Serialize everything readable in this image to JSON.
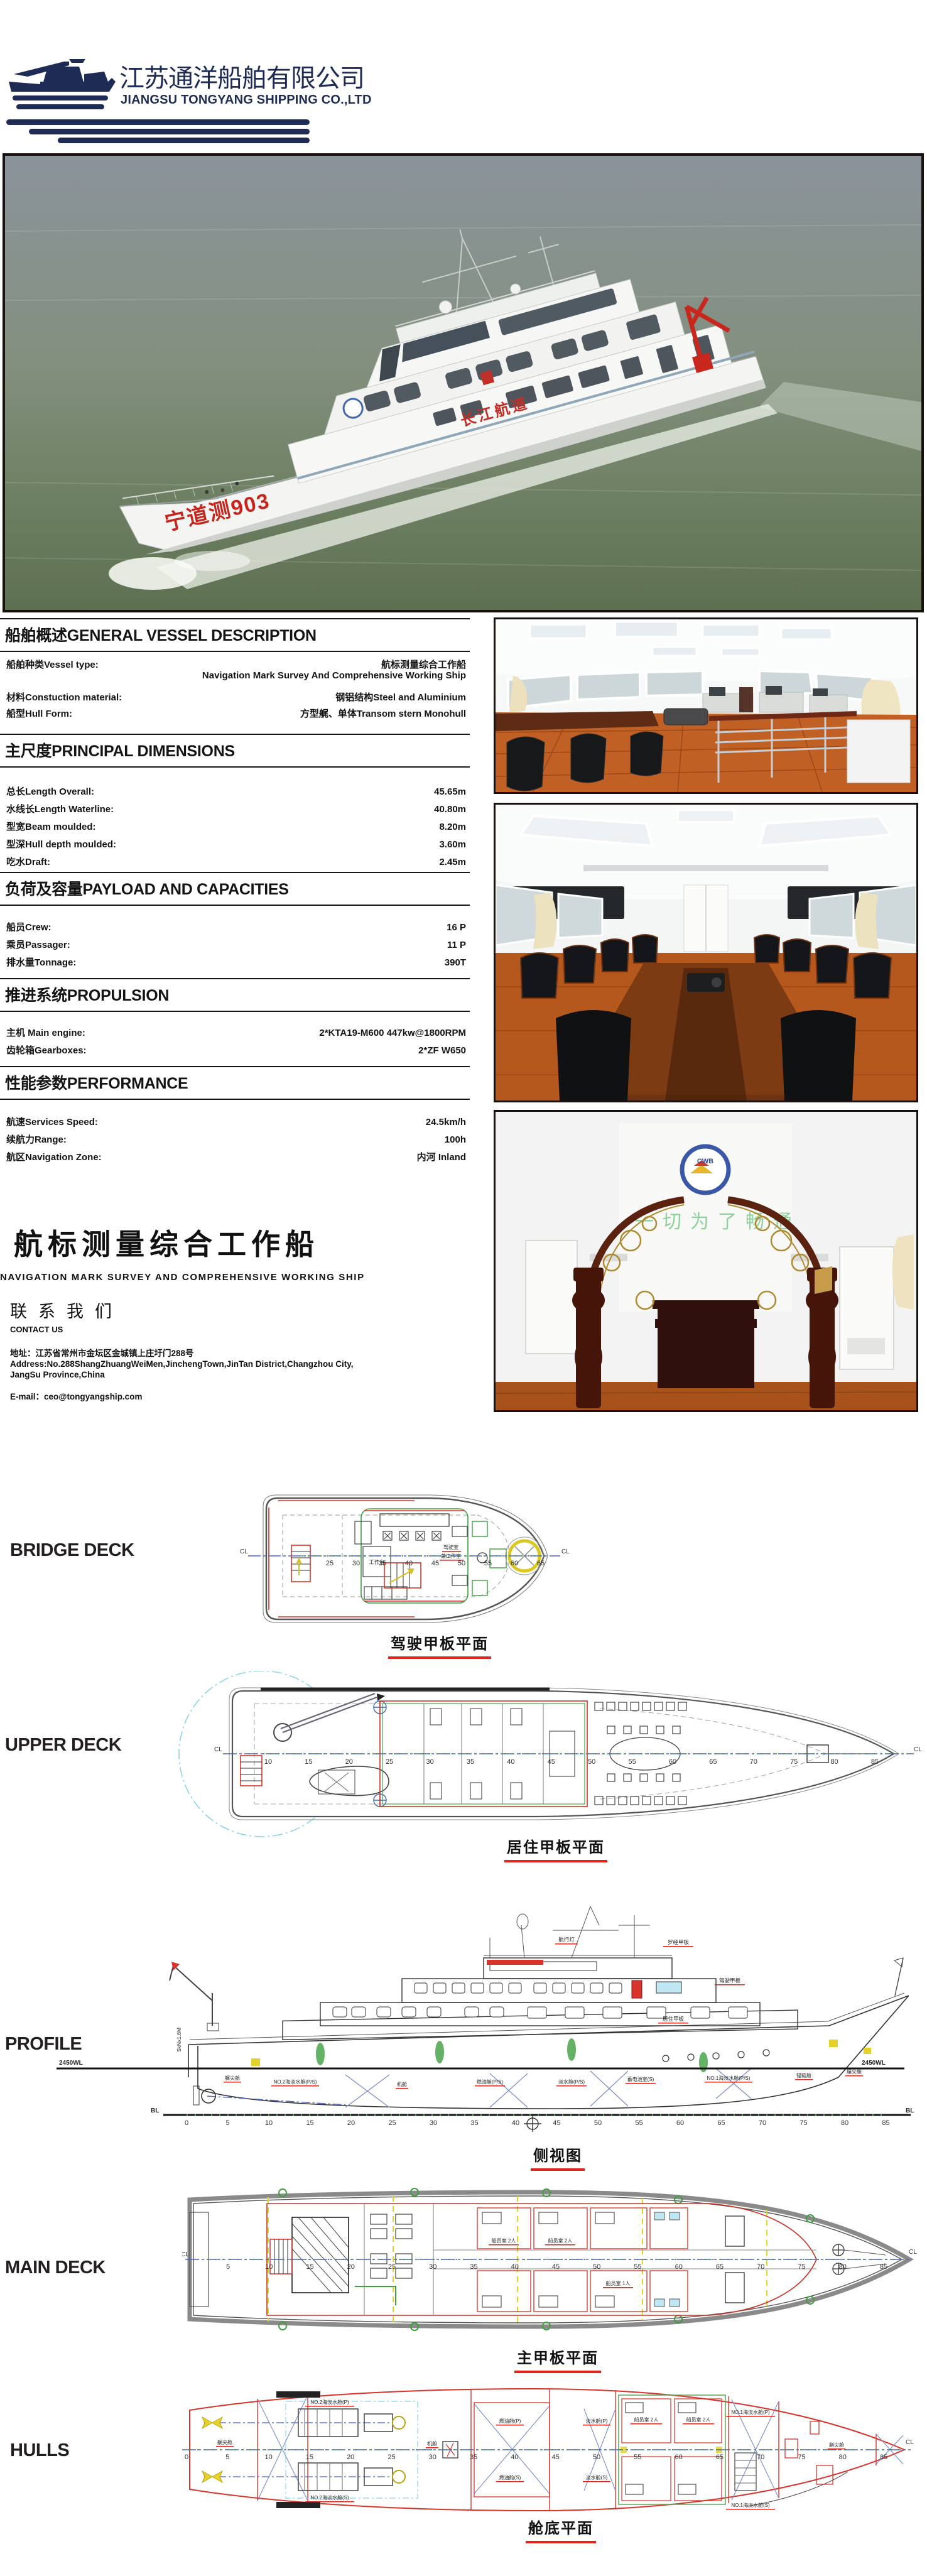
{
  "logo": {
    "company_cn": "江苏通洋船舶有限公司",
    "company_en": "JIANGSU TONGYANG SHIPPING CO.,LTD"
  },
  "main_photo": {
    "hull_name": "宁道测903",
    "side_text": "长江航道"
  },
  "interior": {
    "badge": "CWB",
    "slogan": "一切为了畅通"
  },
  "specs": {
    "general": {
      "title": "船舶概述GENERAL VESSEL DESCRIPTION",
      "rows": [
        {
          "label": "船舶种类Vessel type:",
          "value": "航标测量综合工作船",
          "value2": "Navigation Mark Survey And Comprehensive Working Ship"
        },
        {
          "label": "材料Constuction material:",
          "value": "钢铝结构Steel and Aluminium"
        },
        {
          "label": "船型Hull Form:",
          "value": "方型艉、单体Transom stern  Monohull"
        }
      ]
    },
    "dimensions": {
      "title": "主尺度PRINCIPAL DIMENSIONS",
      "rows": [
        {
          "label": "总长Length Overall:",
          "value": "45.65m"
        },
        {
          "label": "水线长Length Waterline:",
          "value": "40.80m"
        },
        {
          "label": "型宽Beam moulded:",
          "value": "8.20m"
        },
        {
          "label": "型深Hull depth moulded:",
          "value": "3.60m"
        },
        {
          "label": "吃水Draft:",
          "value": "2.45m"
        }
      ]
    },
    "payload": {
      "title": "负荷及容量PAYLOAD AND CAPACITIES",
      "rows": [
        {
          "label": "船员Crew:",
          "value": "16 P"
        },
        {
          "label": "乘员Passager:",
          "value": "11 P"
        },
        {
          "label": "排水量Tonnage:",
          "value": "390T"
        }
      ]
    },
    "propulsion": {
      "title": "推进系统PROPULSION",
      "rows": [
        {
          "label": "主机 Main engine:",
          "value": "2*KTA19-M600 447kw@1800RPM"
        },
        {
          "label": "齿轮箱Gearboxes:",
          "value": "2*ZF W650"
        }
      ]
    },
    "performance": {
      "title": "性能参数PERFORMANCE",
      "rows": [
        {
          "label": "航速Services Speed:",
          "value": "24.5km/h"
        },
        {
          "label": "续航力Range:",
          "value": "100h"
        },
        {
          "label": "航区Navigation Zone:",
          "value": "内河 Inland"
        }
      ]
    }
  },
  "banner": {
    "title_cn": "航标测量综合工作船",
    "title_en": "NAVIGATION MARK SURVEY AND COMPREHENSIVE WORKING SHIP"
  },
  "contact": {
    "heading_cn": "联系我们",
    "heading_en": "CONTACT US",
    "address_cn": "地址：江苏省常州市金坛区金城镇上庄圩门288号",
    "address_en1": "Address:No.288ShangZhuangWeiMen,JinchengTown,JinTan District,Changzhou City,",
    "address_en2": "JangSu Province,China",
    "email": "E-mail：ceo@tongyangship.com"
  },
  "decks": {
    "bridge": {
      "label": "BRIDGE DECK",
      "caption": "驾驶甲板平面",
      "cl": "CL",
      "room1": "工作台",
      "room2a": "驾驶室",
      "room2b": "兼工作室",
      "frames": [
        "25",
        "30",
        "35",
        "40",
        "45",
        "50",
        "55",
        "60",
        "65"
      ]
    },
    "upper": {
      "label": "UPPER DECK",
      "caption": "居住甲板平面",
      "cl": "CL",
      "frames": [
        "10",
        "15",
        "20",
        "25",
        "30",
        "35",
        "40",
        "45",
        "50",
        "55",
        "60",
        "65",
        "70",
        "75",
        "80",
        "85"
      ]
    },
    "profile": {
      "label": "PROFILE",
      "caption": "侧视图",
      "waterline": "2450WL",
      "baseline": "BL",
      "crane": "5kNx1.6M",
      "deck_labels": [
        "航行灯",
        "罗经甲板",
        "驾驶甲板",
        "居住甲板"
      ],
      "compartments": [
        "艉尖舱",
        "NO.2海淡水舱(P/S)",
        "机舱",
        "燃油舱(P/S)",
        "淡水舱(P/S)",
        "蓄电池室(S)",
        "NO.1海淡水舱(P/S)",
        "锚链舱",
        "艏尖舱"
      ],
      "frames": [
        "0",
        "5",
        "10",
        "15",
        "20",
        "25",
        "30",
        "35",
        "40",
        "45",
        "50",
        "55",
        "60",
        "65",
        "70",
        "75",
        "80",
        "85"
      ]
    },
    "main": {
      "label": "MAIN DECK",
      "caption": "主甲板平面",
      "cl": "CL",
      "rooms": [
        "船员室 2人",
        "船员室 2人",
        "船员室 1人"
      ],
      "frames": [
        "5",
        "10",
        "15",
        "20",
        "25",
        "30",
        "35",
        "40",
        "45",
        "50",
        "55",
        "60",
        "65",
        "70",
        "75",
        "80",
        "85"
      ]
    },
    "hulls": {
      "label": "HULLS",
      "caption": "舱底平面",
      "cl": "CL",
      "compartments": [
        "艉尖舱",
        "NO.2海淡水舱(P)",
        "NO.2海淡水舱(S)",
        "机舱",
        "燃油舱(P)",
        "燃油舱(S)",
        "淡水舱(P)",
        "淡水舱(S)",
        "船员室 2人",
        "船员室 2人",
        "NO.1海淡水舱(P)",
        "NO.1海淡水舱(S)",
        "艏尖舱"
      ],
      "frames": [
        "0",
        "5",
        "10",
        "15",
        "20",
        "25",
        "30",
        "35",
        "40",
        "45",
        "50",
        "55",
        "60",
        "65",
        "70",
        "75",
        "80",
        "85"
      ]
    }
  },
  "colors": {
    "navy": "#1e2c55",
    "drawing_red": "#d9342b",
    "caption_red": "#e0251c",
    "centerline_blue": "#4a63b8",
    "tick_green": "#3f9e3f",
    "crane_cyan": "#8ad4e8",
    "highlight_yellow": "#e3d22a"
  }
}
